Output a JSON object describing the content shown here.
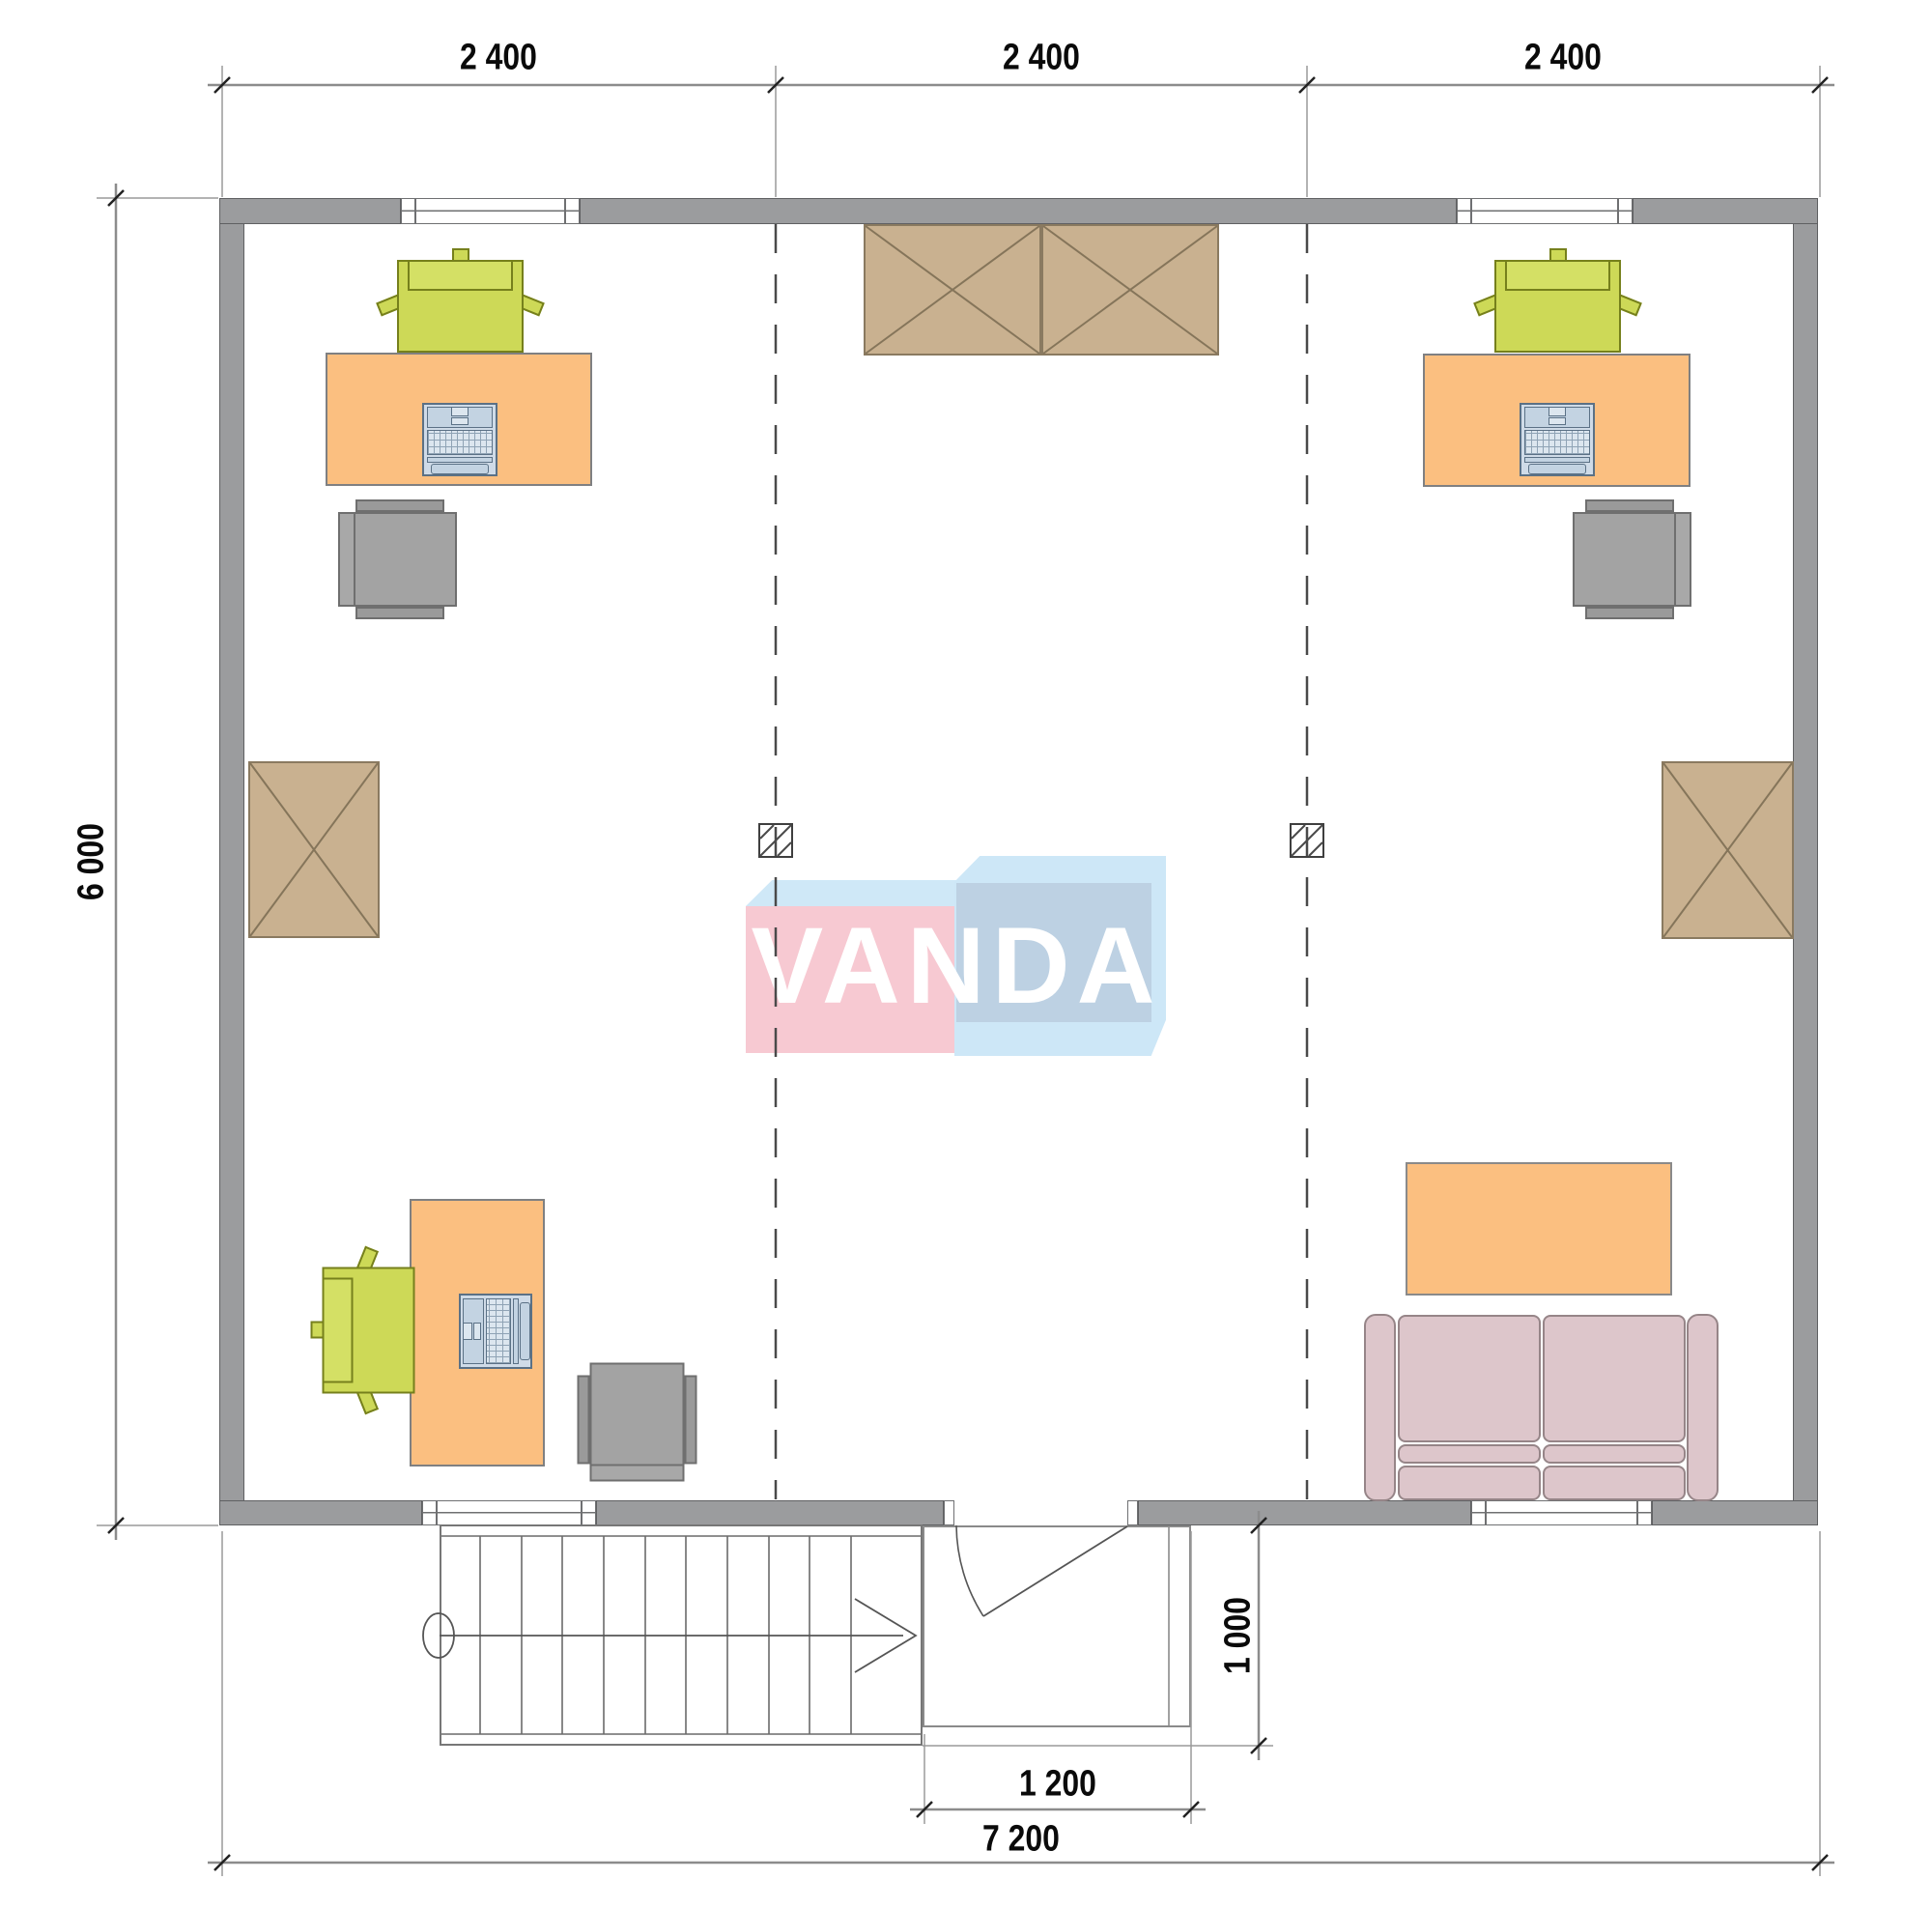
{
  "meta": {
    "drawing_type": "architectural floor plan, top view office layout",
    "logo_text": "VANDA"
  },
  "dimensions": {
    "top_bays": [
      "2 400",
      "2 400",
      "2 400"
    ],
    "height_left": "6 000",
    "entrance_width": "1 200",
    "porch_depth": "1 000",
    "total_width": "7 200"
  },
  "colors": {
    "wall_fill": "#9b9c9e",
    "wall_outline": "#5f6062",
    "desk_fill": "#fbbf80",
    "chair_green": "#cdd957",
    "chair_gray": "#a3a3a3",
    "laptop_fill": "#cfdbe8",
    "cabinet_fill": "#c9b190",
    "sofa_fill": "#ddc6cb",
    "logo_pink": "#f7c9d2",
    "logo_blue": "#cde7f7",
    "logo_blue_gray": "#bdd1e3",
    "dimension_text": "#0a0a0a"
  },
  "elements": {
    "workstations": [
      "top-left desk with green chair, laptop and gray chair",
      "top-right desk with green chair, laptop and gray chair",
      "bottom-left desk with green chair, laptop and gray chair"
    ],
    "storage": [
      "double wardrobe top center",
      "wardrobe left wall",
      "wardrobe right wall"
    ],
    "lounge": [
      "two-seat sofa bottom right",
      "coffee table bottom right"
    ],
    "circulation": [
      "staircase bottom left",
      "entrance door with swing",
      "entrance porch"
    ],
    "structure": [
      "two column grid lines (dashed)",
      "two columns with diagonal hatch"
    ]
  }
}
